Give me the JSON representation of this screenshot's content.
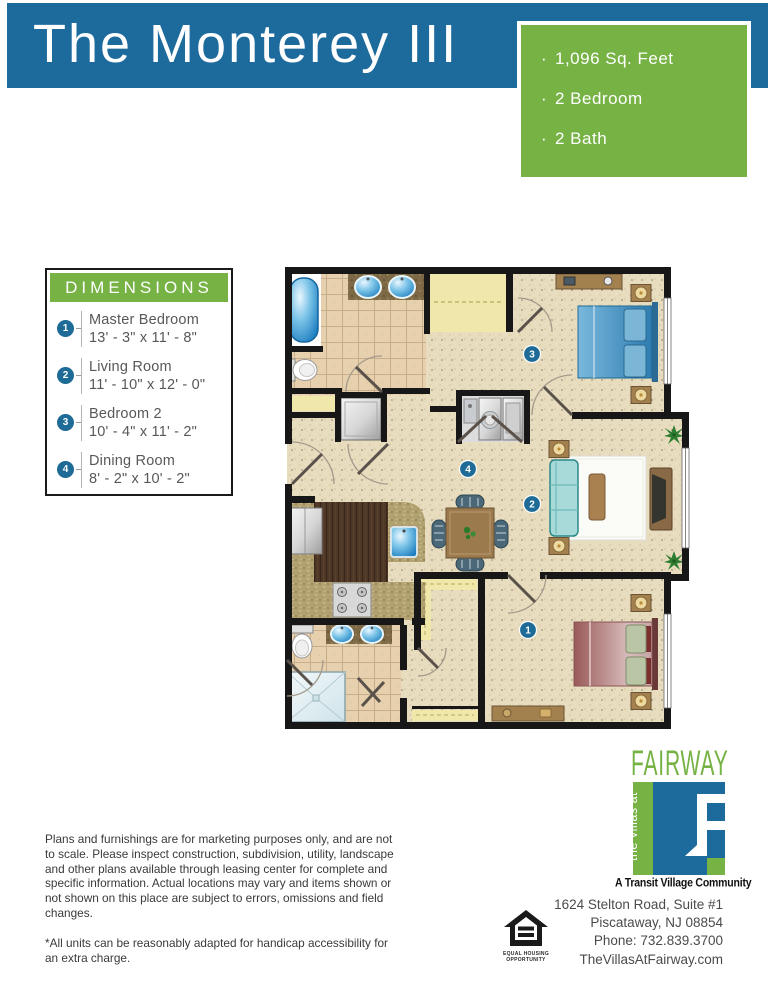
{
  "header": {
    "title": "The Monterey III"
  },
  "specs": {
    "items": [
      {
        "bullet": "·",
        "label": "1,096 Sq. Feet"
      },
      {
        "bullet": "·",
        "label": "2 Bedroom"
      },
      {
        "bullet": "·",
        "label": "2 Bath"
      }
    ]
  },
  "dimensions": {
    "title": "DIMENSIONS",
    "items": [
      {
        "num": "1",
        "name": "Master Bedroom",
        "size": "13' - 3\" x 11' - 8\""
      },
      {
        "num": "2",
        "name": "Living Room",
        "size": "11' - 10\" x 12' - 0\""
      },
      {
        "num": "3",
        "name": "Bedroom 2",
        "size": "10' - 4\" x 11' - 2\""
      },
      {
        "num": "4",
        "name": "Dining Room",
        "size": "8' - 2\" x 10' - 2\""
      }
    ]
  },
  "floor_plan": {
    "markers": {
      "master_bedroom": "1",
      "living_room": "2",
      "bedroom_2": "3",
      "dining_room": "4"
    }
  },
  "disclaimer": {
    "body": "Plans and furnishings are for marketing purposes only, and are not to scale. Please inspect construction, subdivision, utility, landscape and other plans available through leasing center for complete and specific information. Actual locations may vary and items shown or not shown on this place are subject to errors, omissions and field changes.",
    "note": "*All units can be reasonably adapted for handicap accessibility for an extra charge."
  },
  "equal_housing": {
    "line1": "EQUAL HOUSING",
    "line2": "OPPORTUNITY"
  },
  "brand": {
    "wordmark": "FAIRWAY",
    "vertical": "the villas at",
    "tagline": "A Transit Village Community"
  },
  "contact": {
    "address1": "1624 Stelton Road, Suite #1",
    "address2": "Piscataway, NJ 08854",
    "phone": "Phone: 732.839.3700",
    "website": "TheVillasAtFairway.com"
  },
  "colors": {
    "banner_blue": "#1d6a9d",
    "accent_green": "#76b244",
    "badge_teal": "#1d6b96"
  }
}
